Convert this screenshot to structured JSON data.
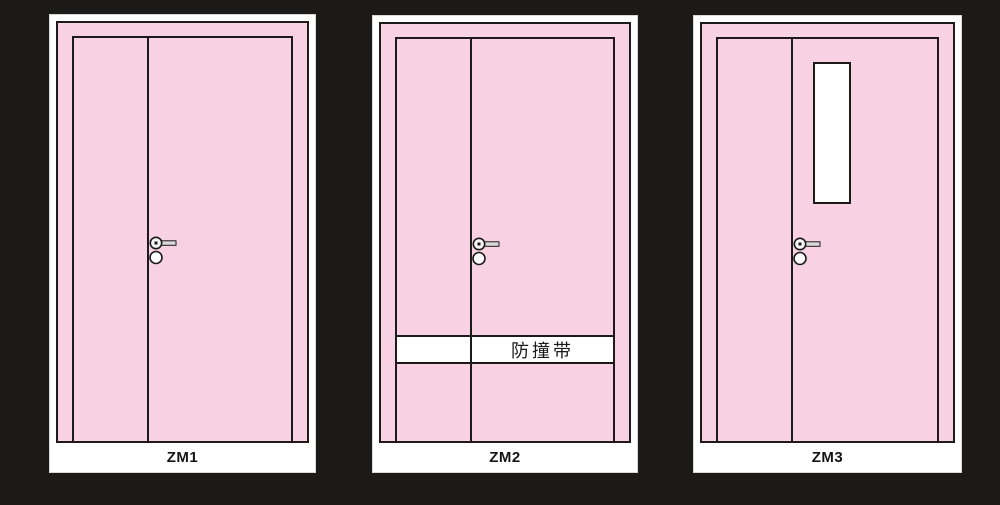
{
  "canvas": {
    "width": 1000,
    "height": 505,
    "background_color": "#1c1a19"
  },
  "colors": {
    "door_fill": "#f8d2e2",
    "outline": "#1d1a1a",
    "panel_bg": "#ffffff",
    "handle_fill": "#d9d9d9"
  },
  "icons": {
    "handle": "lever-handle-icon",
    "lock": "lock-cylinder-icon"
  },
  "doors": [
    {
      "label": "ZM1"
    },
    {
      "label": "ZM2",
      "band_label": "防撞带"
    },
    {
      "label": "ZM3"
    }
  ]
}
